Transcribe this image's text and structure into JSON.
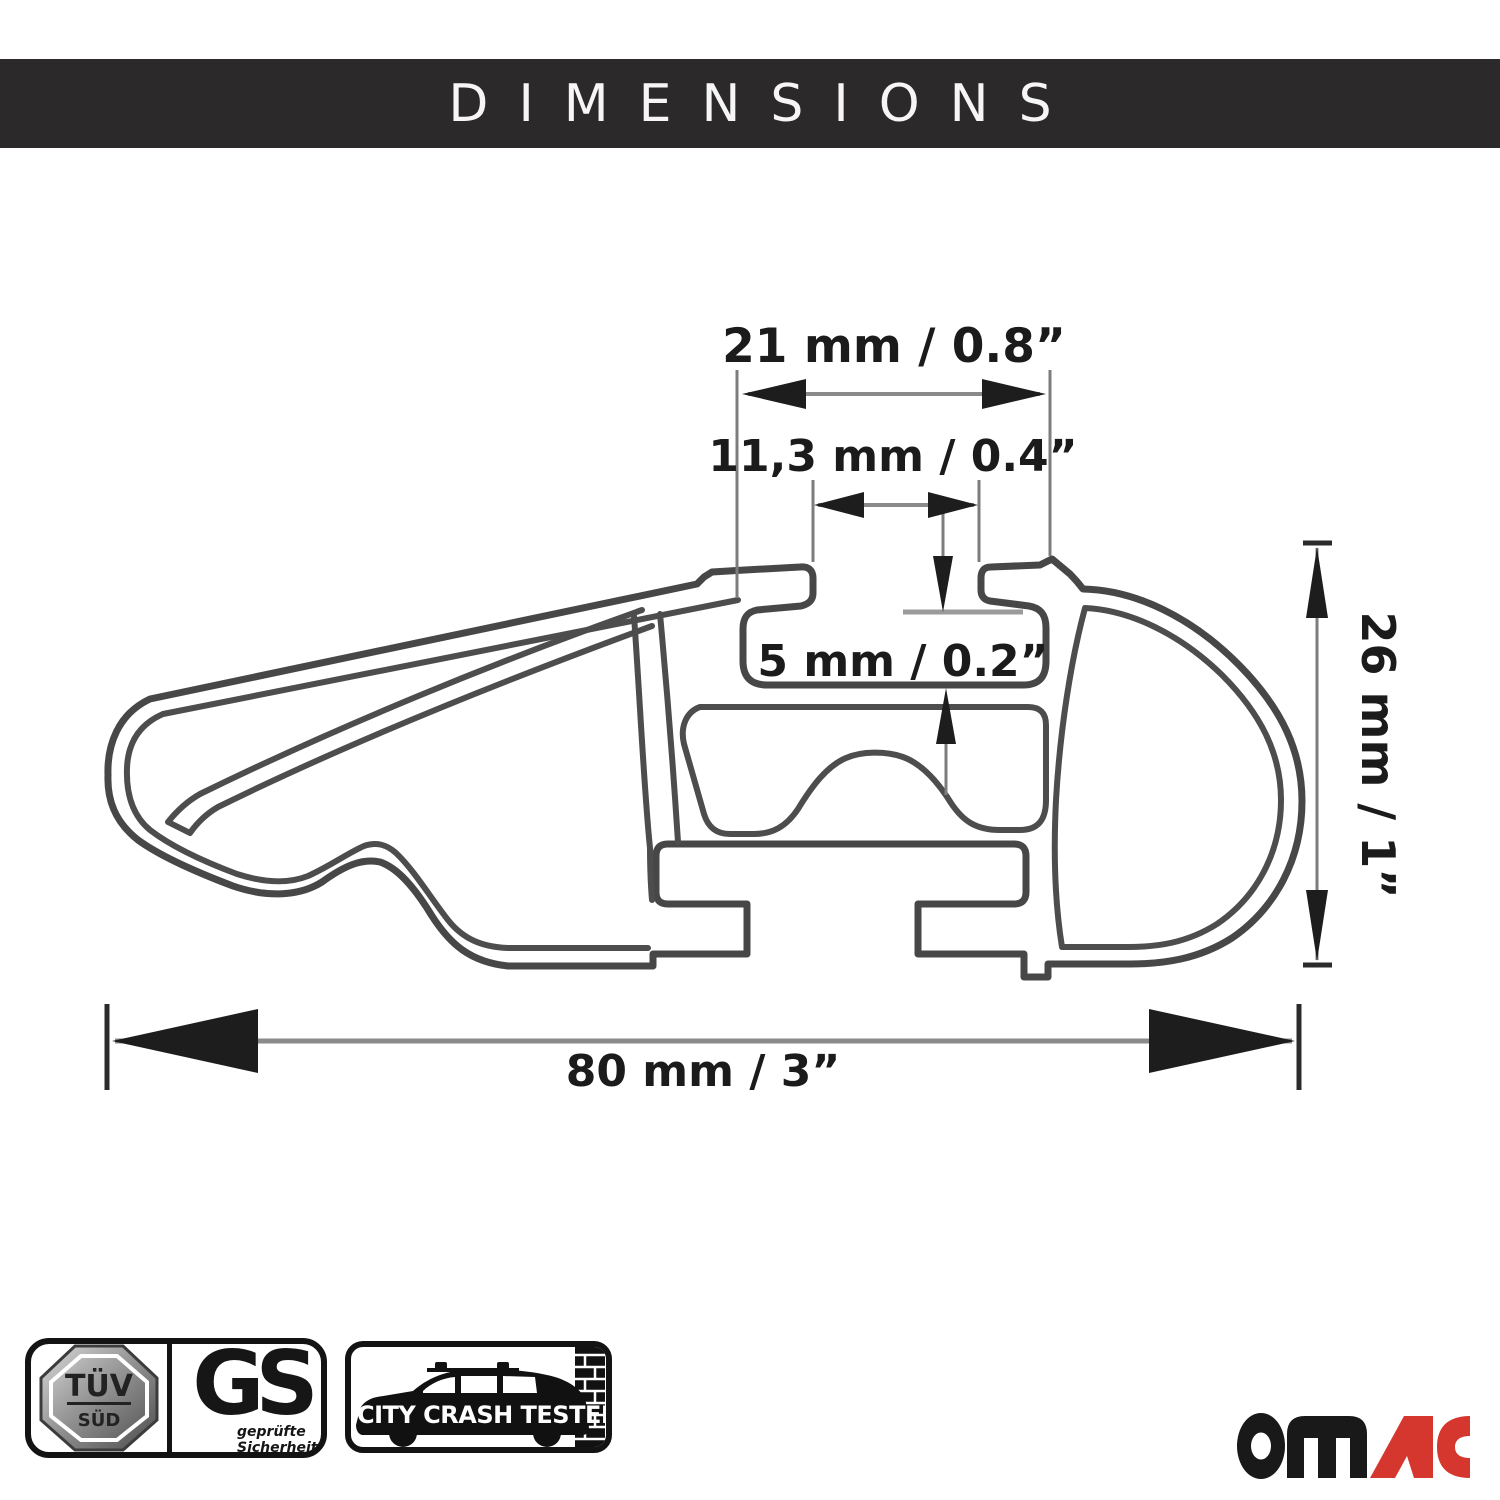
{
  "header": {
    "title": "DIMENSIONS",
    "bg_color": "#2b292a"
  },
  "diagram": {
    "type": "roof-rack crossbar cross-section",
    "labels": {
      "slot_outer_width": "21 mm / 0.8”",
      "slot_opening_width": "11,3 mm / 0.4”",
      "slot_depth": "5 mm / 0.2”",
      "total_width": "80 mm / 3”",
      "total_height": "26 mm / 1”"
    },
    "line_color": "#474747",
    "dimension_color": "#1d1d1d"
  },
  "badges": {
    "tuv": {
      "line1": "TÜV",
      "line2": "SÜD"
    },
    "gs": {
      "big": "GS",
      "small1": "geprüfte",
      "small2": "Sicherheit"
    },
    "crash": {
      "label": "CITY CRASH TESTED"
    }
  },
  "logo": {
    "black_part": "OM",
    "red_part": "AC",
    "red_color": "#d5372f",
    "black_color": "#191919"
  }
}
